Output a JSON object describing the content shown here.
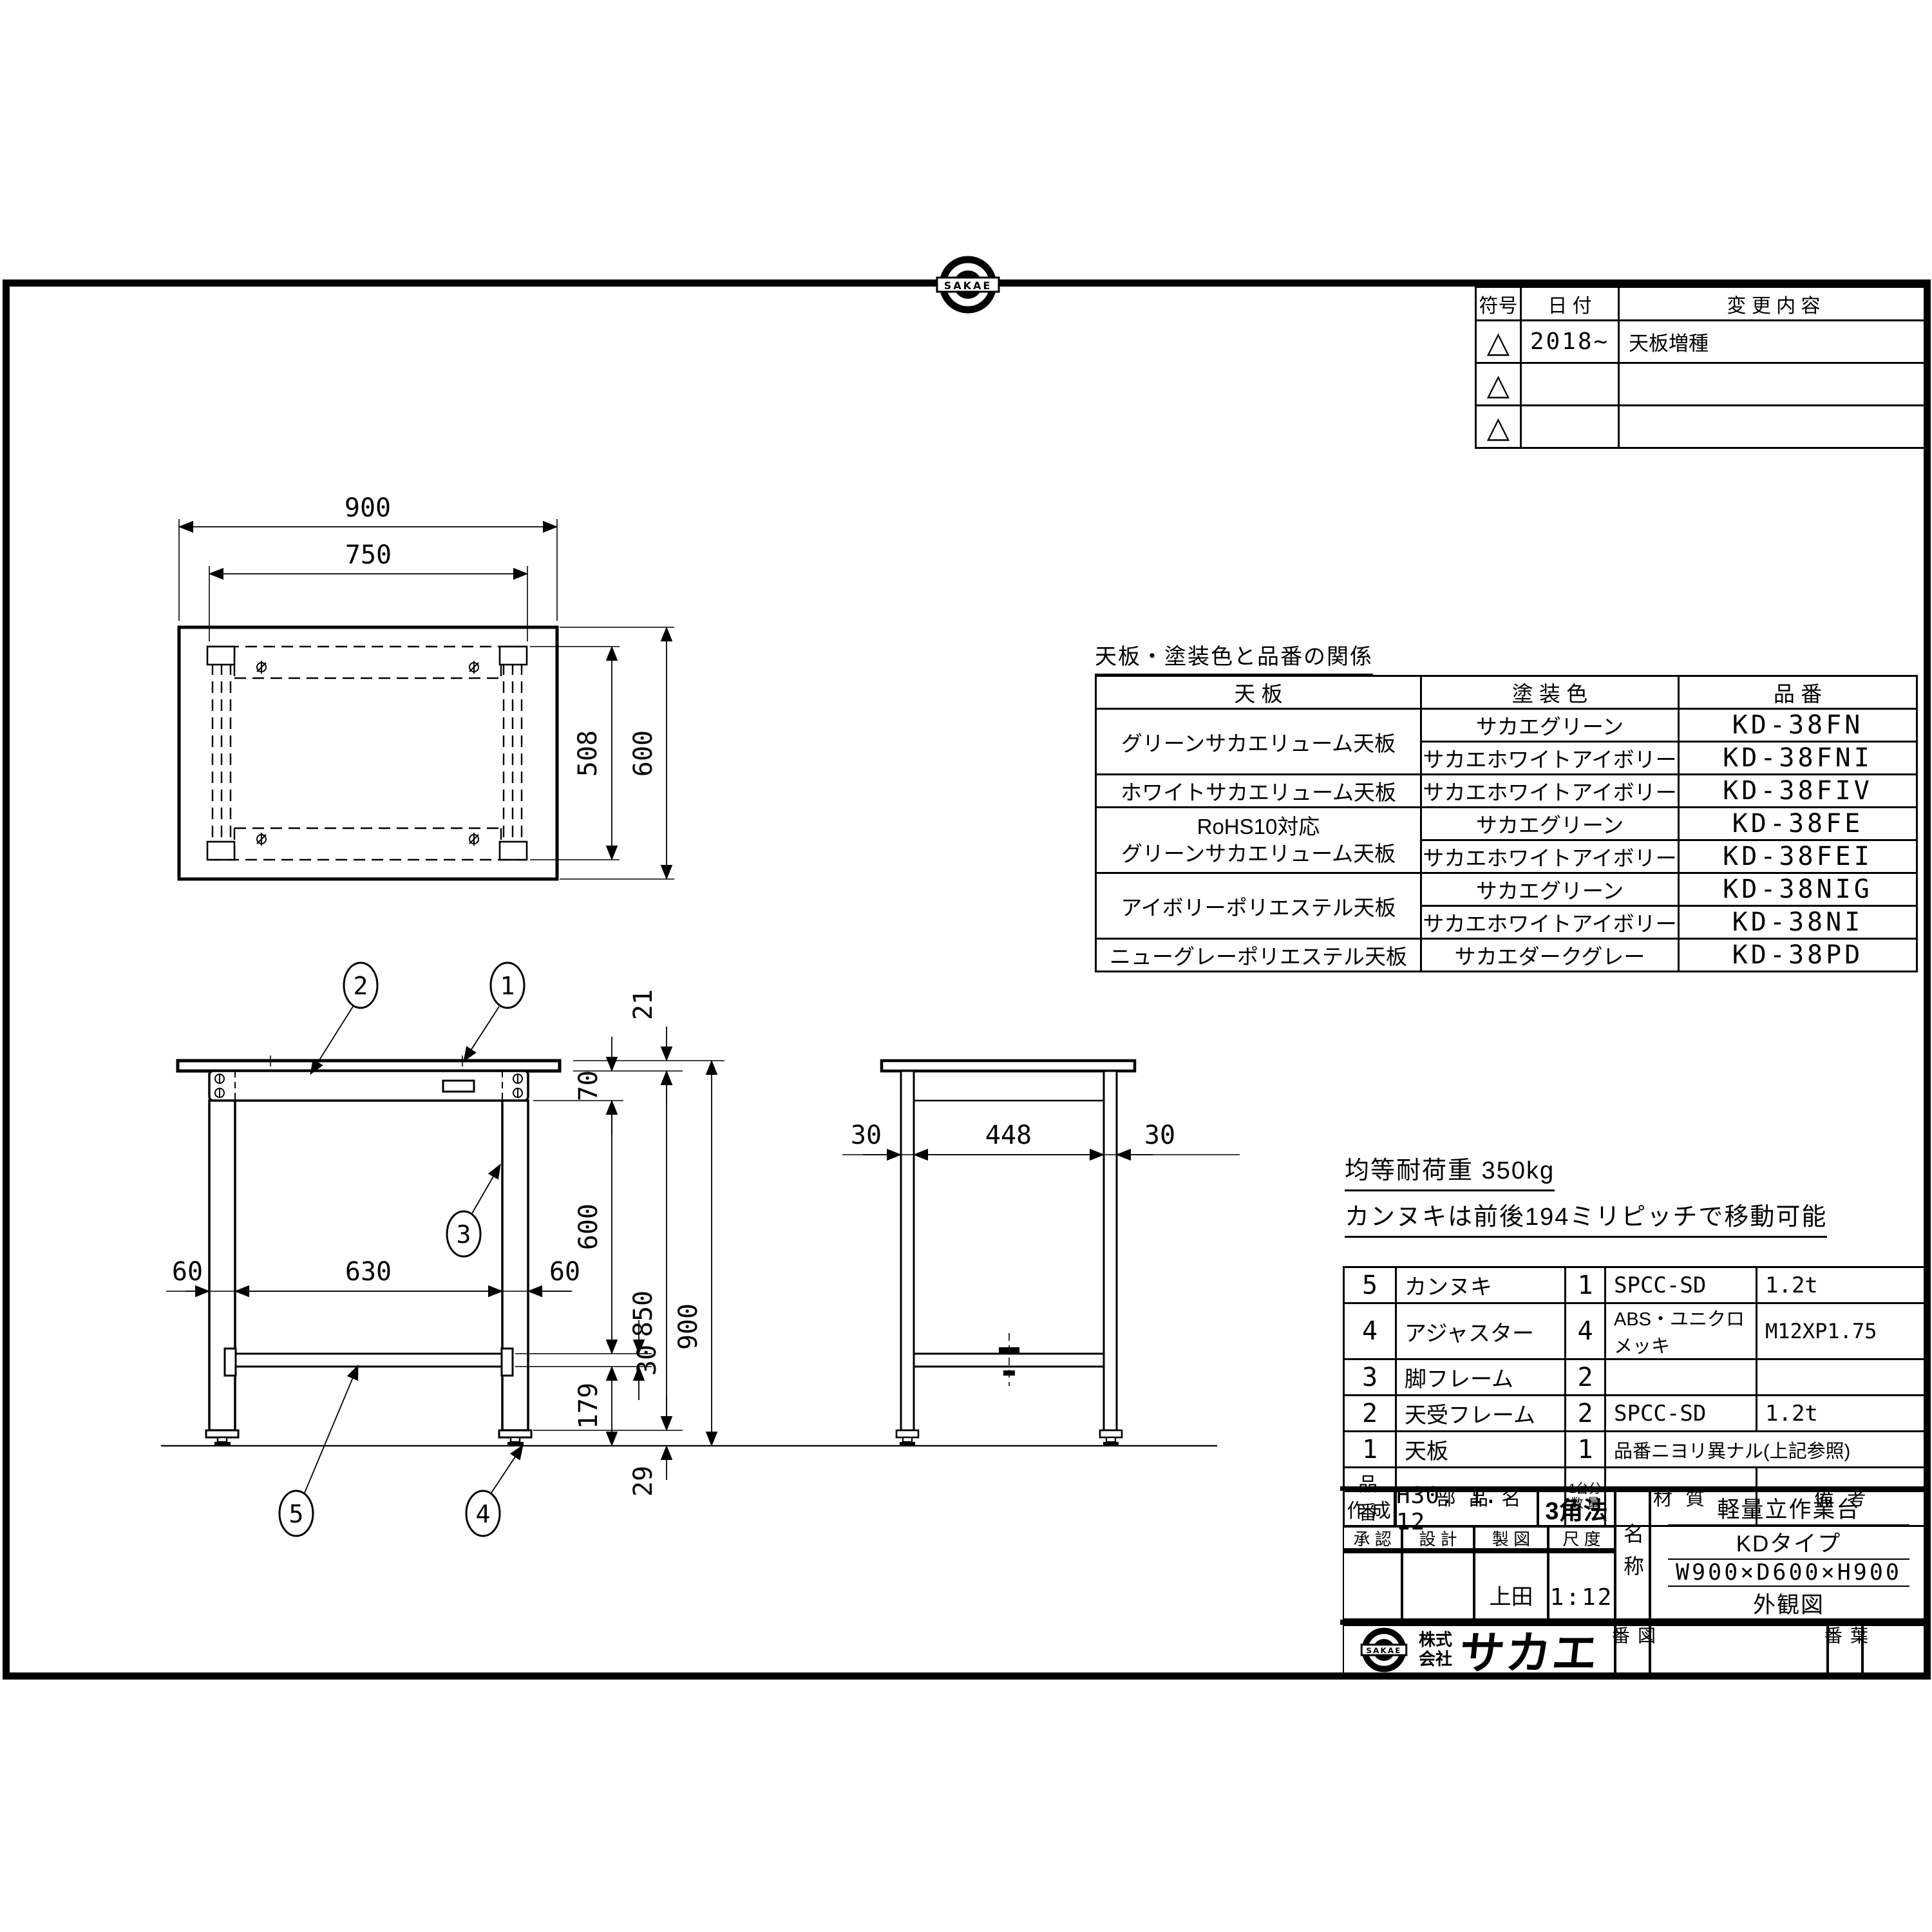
{
  "revision_table": {
    "col_symbol": "符号",
    "col_date": "日  付",
    "col_change": "変 更 内 容",
    "rows": [
      {
        "symbol": "△",
        "date": "2018~",
        "change": "天板増種"
      },
      {
        "symbol": "△",
        "date": "",
        "change": ""
      },
      {
        "symbol": "△",
        "date": "",
        "change": ""
      }
    ]
  },
  "logo": {
    "mark": "SAKAE",
    "prefix1": "株式",
    "prefix2": "会社",
    "name": "サカエ"
  },
  "color_table": {
    "title": "天板・塗装色と品番の関係",
    "col_top": "天  板",
    "col_color": "塗 装 色",
    "col_code": "品  番",
    "rows": [
      {
        "top": "グリーンサカエリューム天板",
        "color": "サカエグリーン",
        "code": "KD-38FN"
      },
      {
        "color": "サカエホワイトアイボリー",
        "code": "KD-38FNI"
      },
      {
        "top": "ホワイトサカエリューム天板",
        "color": "サカエホワイトアイボリー",
        "code": "KD-38FIV"
      },
      {
        "top": "RoHS10対応\nグリーンサカエリューム天板",
        "color": "サカエグリーン",
        "code": "KD-38FE"
      },
      {
        "color": "サカエホワイトアイボリー",
        "code": "KD-38FEI"
      },
      {
        "top": "アイボリーポリエステル天板",
        "color": "サカエグリーン",
        "code": "KD-38NIG"
      },
      {
        "color": "サカエホワイトアイボリー",
        "code": "KD-38NI"
      },
      {
        "top": "ニューグレーポリエステル天板",
        "color": "サカエダークグレー",
        "code": "KD-38PD"
      }
    ]
  },
  "notes": {
    "load": "均等耐荷重  350kg",
    "pitch": "カンヌキは前後194ミリピッチで移動可能"
  },
  "parts_table": {
    "h_no": "品 番",
    "h_name": "部 品 名",
    "h_qty": "1台分\n数 量",
    "h_material": "材   質",
    "h_remarks": "備   考",
    "rows": [
      {
        "no": "5",
        "name": "カンヌキ",
        "qty": "1",
        "material": "SPCC-SD",
        "remarks": "1.2t"
      },
      {
        "no": "4",
        "name": "アジャスター",
        "qty": "4",
        "material": "ABS・ユニクロメッキ",
        "remarks": "M12XP1.75"
      },
      {
        "no": "3",
        "name": "脚フレーム",
        "qty": "2",
        "material": "",
        "remarks": ""
      },
      {
        "no": "2",
        "name": "天受フレーム",
        "qty": "2",
        "material": "SPCC-SD",
        "remarks": "1.2t"
      },
      {
        "no": "1",
        "name": "天板",
        "qty": "1",
        "material": "品番ニヨリ異ナル(上記参照)",
        "remarks": ""
      }
    ]
  },
  "title_block": {
    "created_label": "作 成",
    "created_value": "H30. 1. 12",
    "projection": "3角法",
    "approval_label": "承 認",
    "design_label": "設 計",
    "drafting_label": "製 図",
    "scale_label": "尺 度",
    "drafter": "上田",
    "scale_value": "1:12",
    "name_label": "名称",
    "name1": "軽量立作業台",
    "name2": "KDタイプ",
    "name3": "W900×D600×H900",
    "name4": "外観図",
    "drawing_no_label": "図番",
    "sheet_no_label": "葉番"
  },
  "dims": {
    "top": {
      "w900": "900",
      "w750": "750",
      "d508": "508",
      "d600": "600"
    },
    "front": {
      "t21": "21",
      "h70": "70",
      "w60l": "60",
      "w630": "630",
      "w60r": "60",
      "h600": "600",
      "h850": "850",
      "h900": "900",
      "h30": "30",
      "h179": "179",
      "h29": "29"
    },
    "side": {
      "w30l": "30",
      "w448": "448",
      "w30r": "30"
    }
  },
  "balloons": {
    "b1": "1",
    "b2": "2",
    "b3": "3",
    "b4": "4",
    "b5": "5"
  }
}
